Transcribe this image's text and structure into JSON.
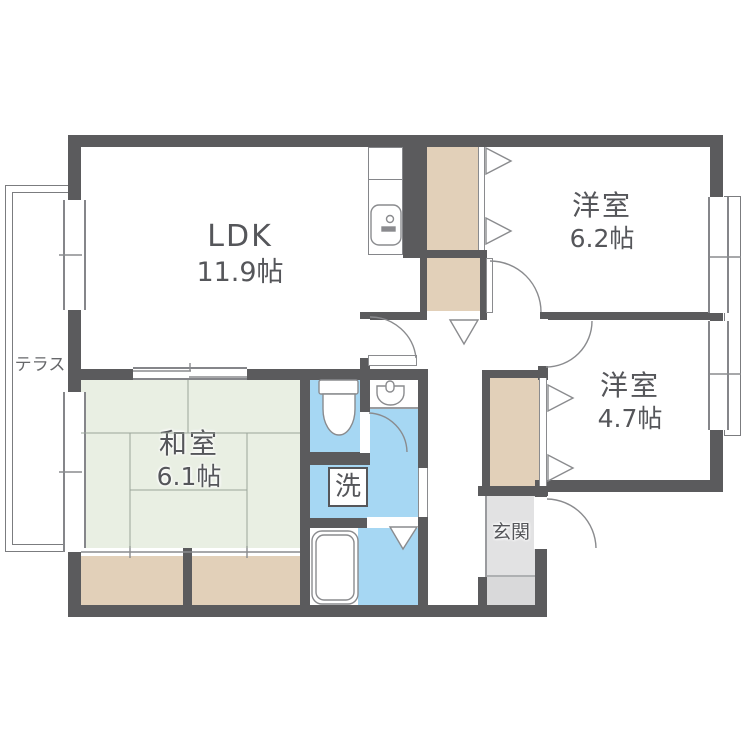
{
  "plan_type": "apartment-floor-plan",
  "rooms": {
    "ldk": {
      "name": "LDK",
      "size": "11.9帖"
    },
    "yoshitsu_a": {
      "name": "洋室",
      "size": "6.2帖"
    },
    "yoshitsu_b": {
      "name": "洋室",
      "size": "4.7帖"
    },
    "washitsu": {
      "name": "和室",
      "size": "6.1帖"
    },
    "genkan": {
      "name": "玄関"
    },
    "laundry": {
      "name": "洗"
    },
    "terrace": {
      "name": "テラス"
    }
  },
  "fixtures": {
    "kitchen_sink": "kitchen-sink",
    "toilet": "toilet",
    "washbasin": "washbasin",
    "bathtub": "bathtub",
    "washing_machine_pan": "washing-machine-pan"
  },
  "colors": {
    "wall": "#5b5b5d",
    "tatami": "#e9efe3",
    "closet": "#e2d0b9",
    "wet_area": "#a6d7f3",
    "genkan_floor": "#e2e2e3",
    "text": "#55565a",
    "thin_line": "#8a8b8e"
  }
}
